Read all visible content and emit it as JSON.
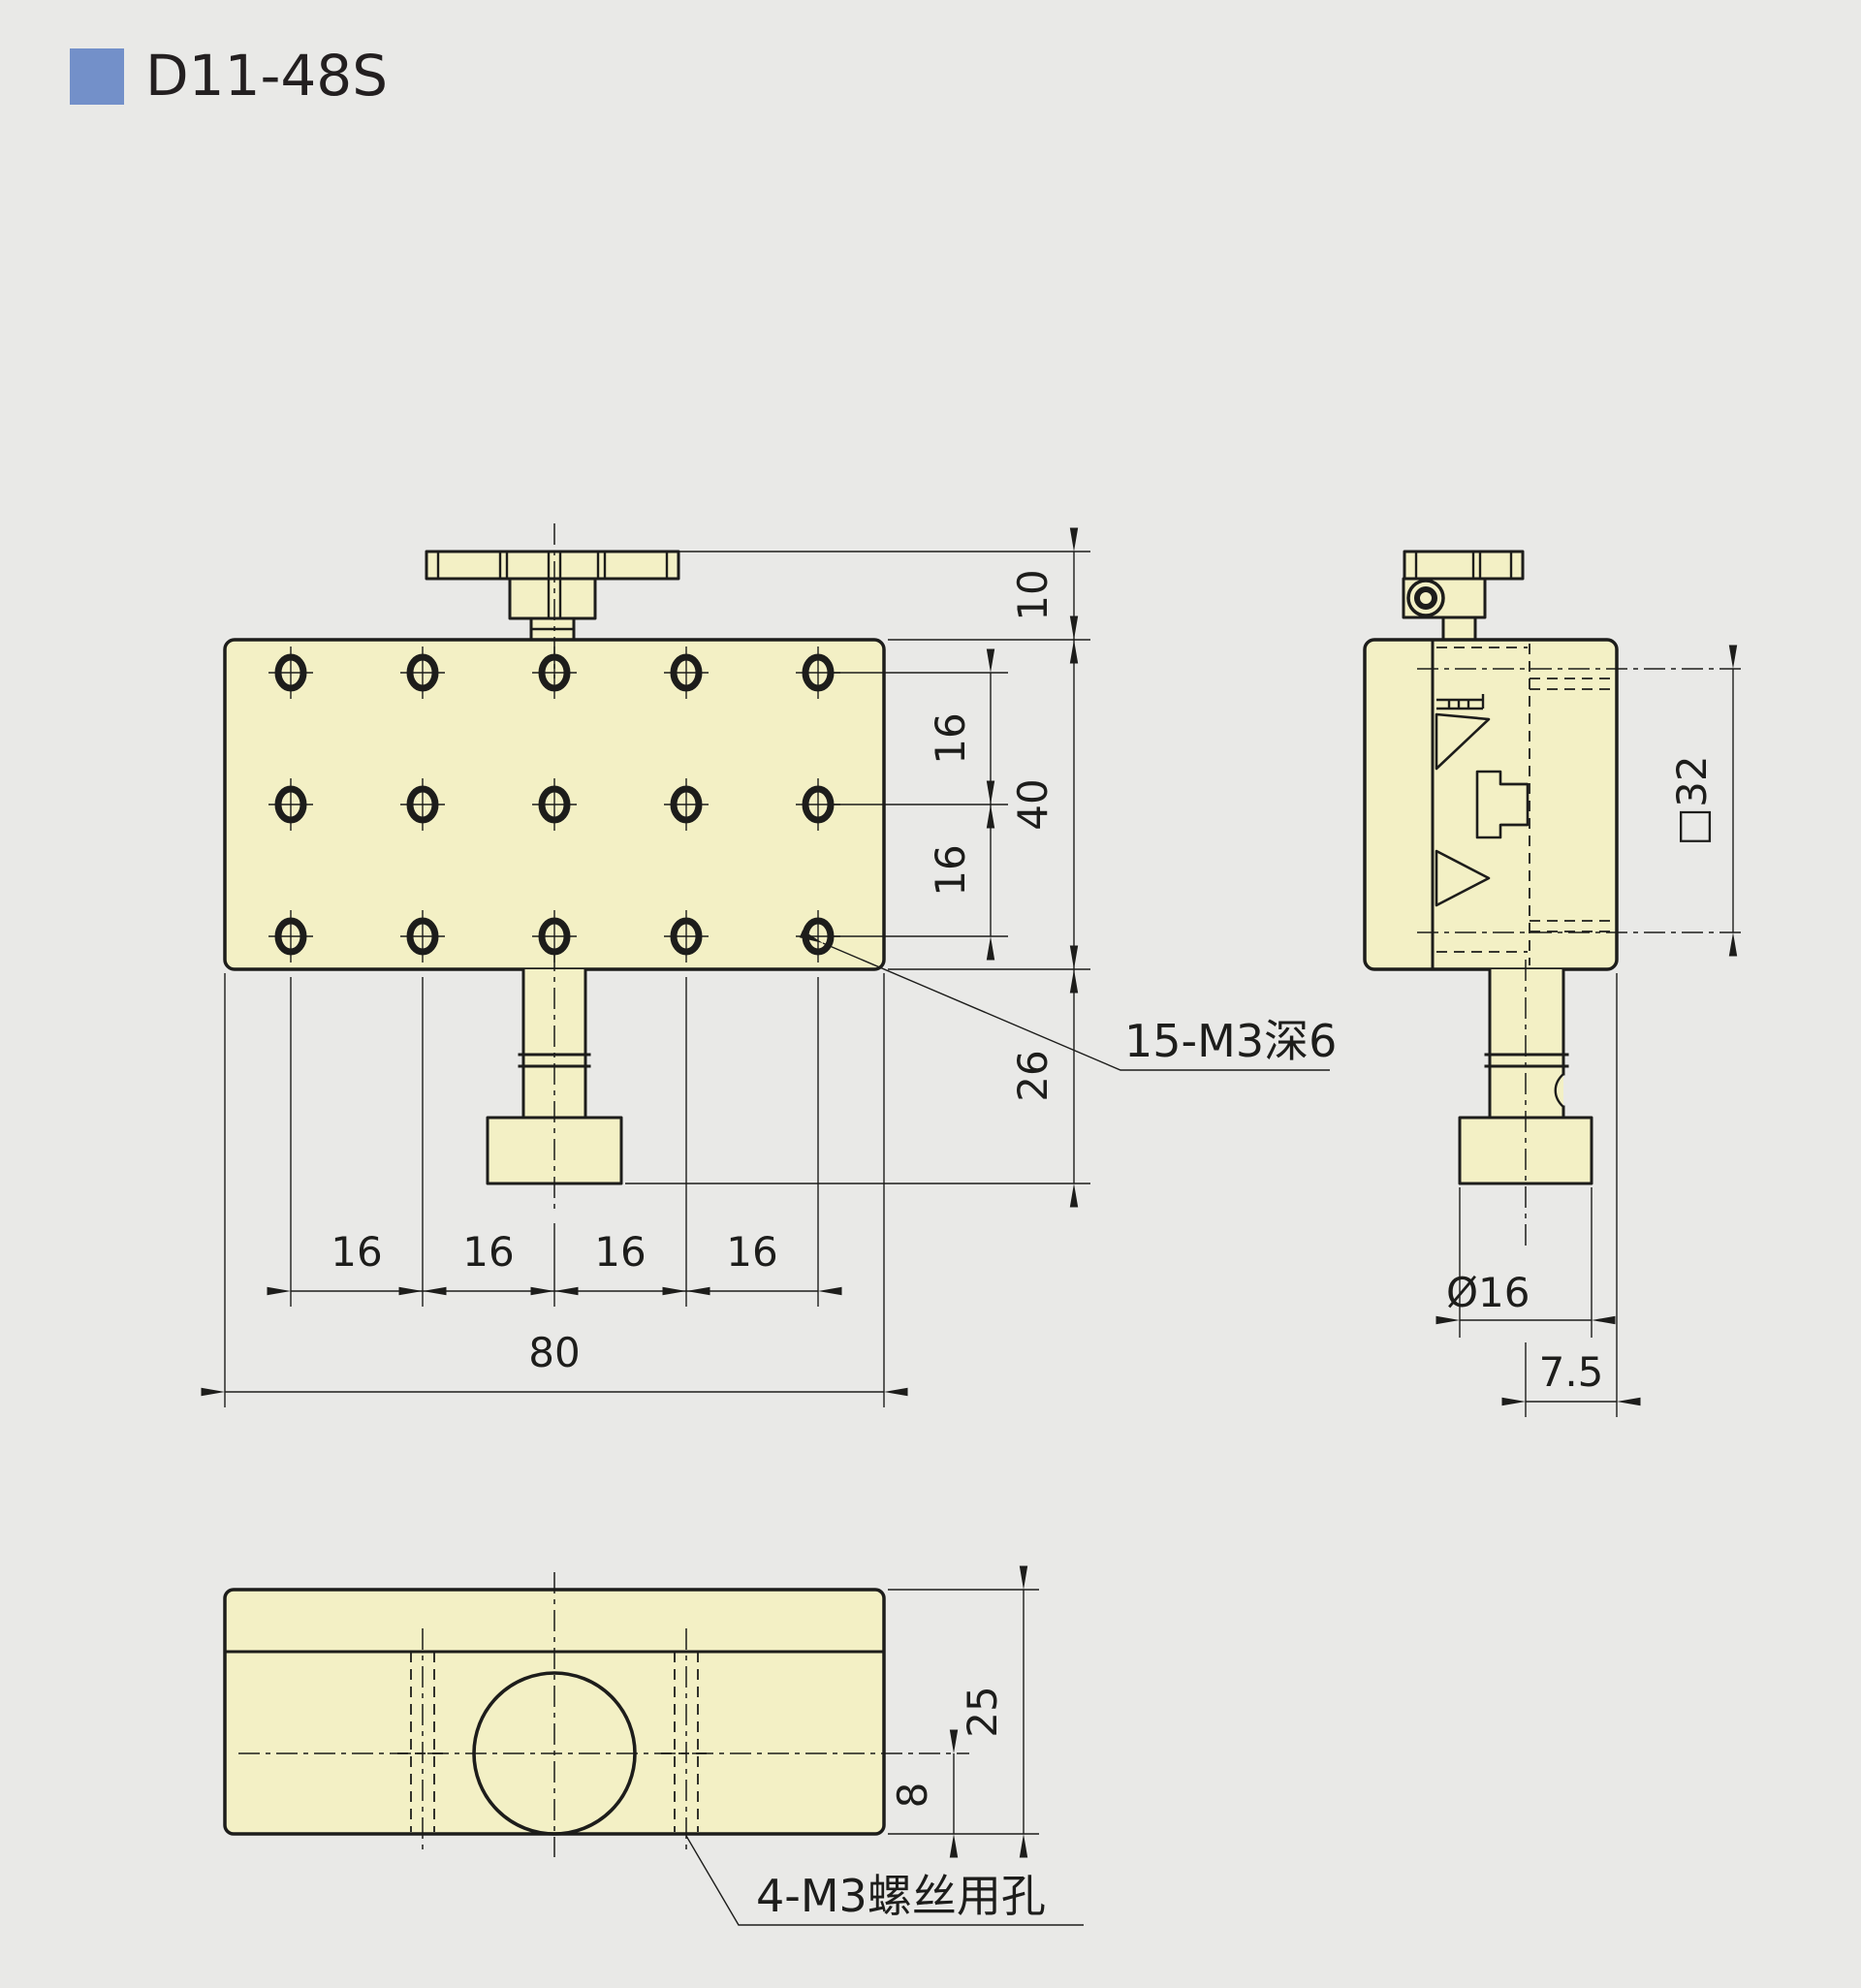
{
  "title": "D11-48S",
  "views": {
    "front": {
      "hole_label": "15-M3深6",
      "dims": {
        "knob_clearance": "10",
        "plate_height": "40",
        "row_pitches": [
          "16",
          "16"
        ],
        "stem_length": "26",
        "col_pitches": [
          "16",
          "16",
          "16",
          "16"
        ],
        "overall_width": "80"
      }
    },
    "side": {
      "dims": {
        "platform_size": "□32",
        "knob_diameter": "Ø16",
        "knob_offset": "7.5"
      }
    },
    "bottom": {
      "hole_label": "4-M3螺丝用孔",
      "dims": {
        "body_depth": "25",
        "knob_center_height": "8"
      }
    }
  },
  "colors": {
    "background": "#e9e9e7",
    "part_fill": "#f3f0c5",
    "line": "#1d1d1b",
    "accent_blue": "#7390c9"
  }
}
